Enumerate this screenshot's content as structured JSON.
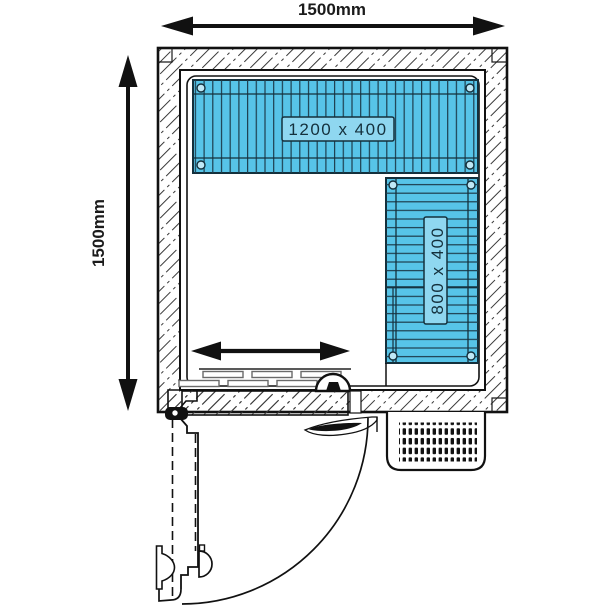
{
  "diagram": {
    "title": "Cold room floor plan 1500 x 1500",
    "dim_top": "1500mm",
    "dim_left": "1500mm",
    "shelf_top_label": "1200 x 400",
    "shelf_right_label": "800 x 400"
  },
  "icons": {
    "top_dimension": "double-arrow-horizontal",
    "left_dimension": "double-arrow-vertical",
    "clearance": "double-arrow-horizontal",
    "door_swing": "quarter-arc",
    "vent": "ventilation-grille"
  },
  "colors": {
    "shelf_fill": "#57C4E8",
    "shelf_label_fill": "#8FD7F0",
    "line": "#111111"
  }
}
